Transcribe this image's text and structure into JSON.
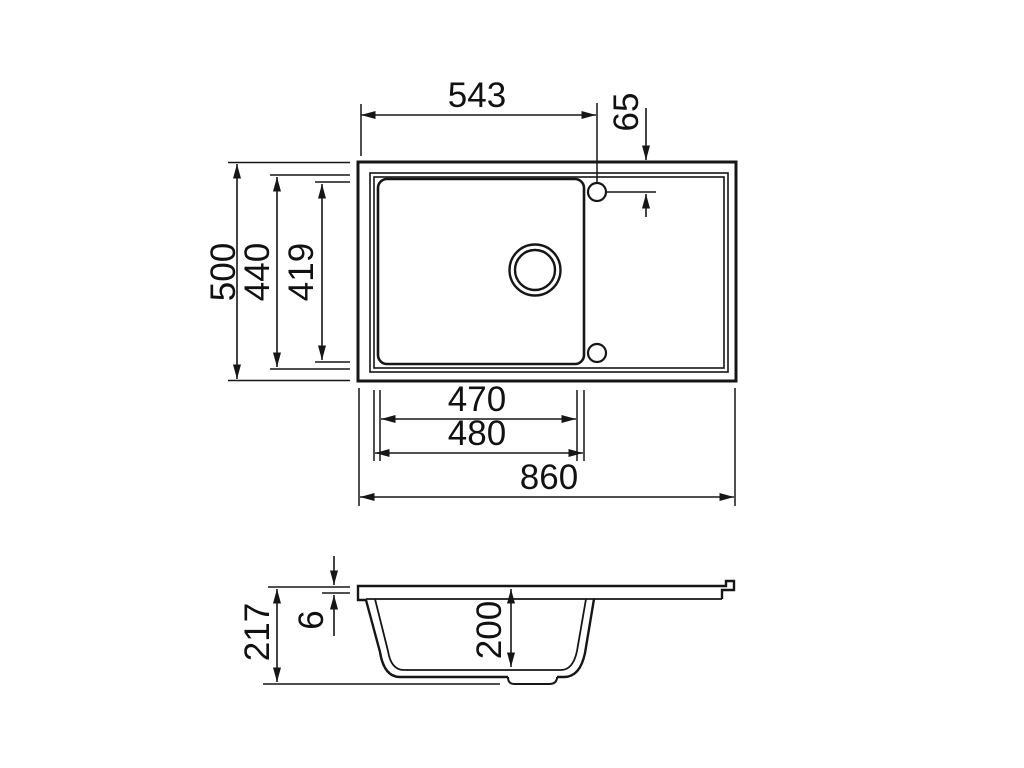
{
  "diagram": {
    "kind": "technical-dimension-drawing",
    "subject": "kitchen sink with bowl and drainer, top view and side section",
    "line_color": "#161616",
    "background_color": "#ffffff",
    "top_view": {
      "overall_width": "860",
      "overall_depth": "500",
      "rim_depth": "440",
      "bowl_front_back": "419",
      "bowl_width_inner": "470",
      "bowl_width_outer": "480",
      "taphole_offset_left": "543",
      "taphole_offset_top": "65"
    },
    "side_view": {
      "overall_height": "217",
      "rim_thickness": "6",
      "bowl_depth": "200"
    }
  }
}
